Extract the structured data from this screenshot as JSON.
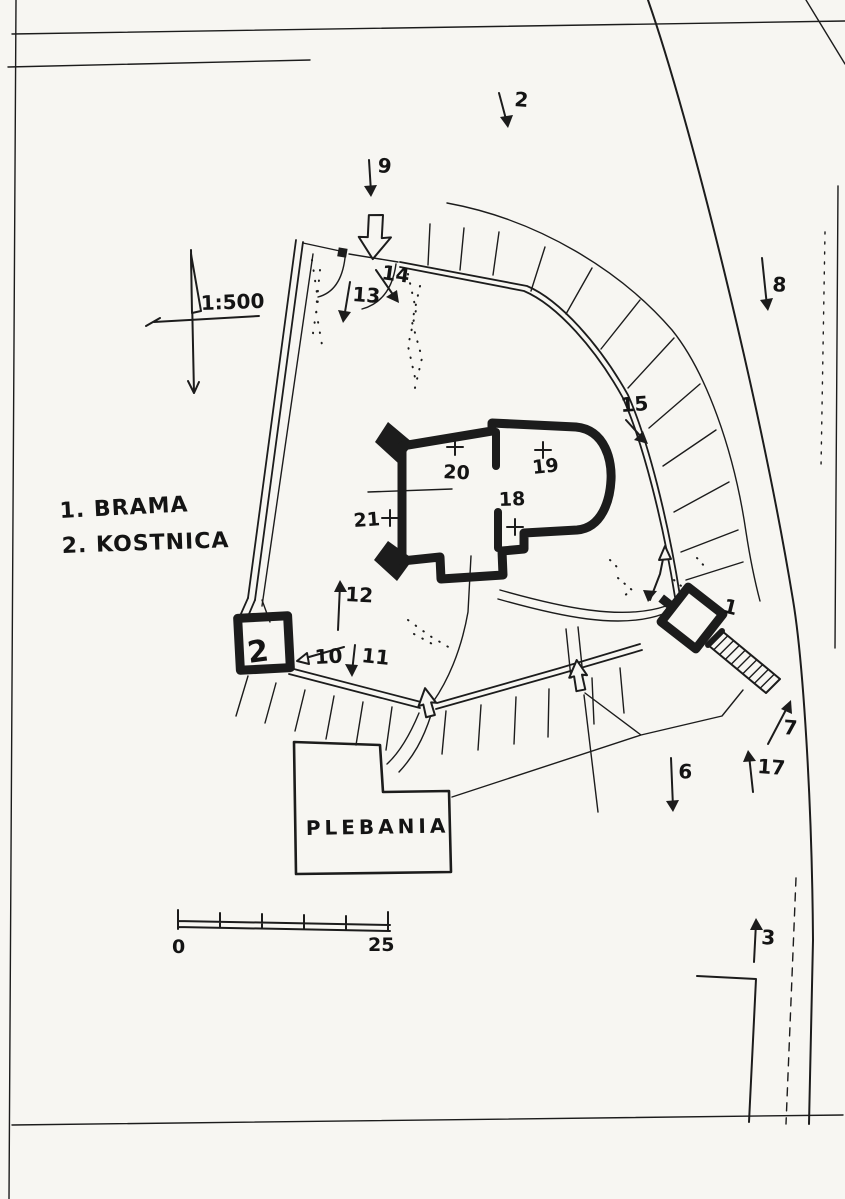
{
  "legend": [
    "1. BRAMA",
    "2. KOSTNICA"
  ],
  "scale": {
    "ratio": "1:500"
  },
  "scale_bar": {
    "start": "0",
    "end": "25"
  },
  "buildings": {
    "plebania": "PLEBANIA"
  },
  "structure_labels": {
    "gate": "1",
    "kostnica": "2"
  },
  "numbers": {
    "n2": "2",
    "n3": "3",
    "n6": "6",
    "n7": "7",
    "n8": "8",
    "n9": "9",
    "n10": "10",
    "n11": "11",
    "n12": "12",
    "n13": "13",
    "n14": "14",
    "n15": "15",
    "n17": "17",
    "n18": "18",
    "n19": "19",
    "n20": "20",
    "n21": "21"
  }
}
